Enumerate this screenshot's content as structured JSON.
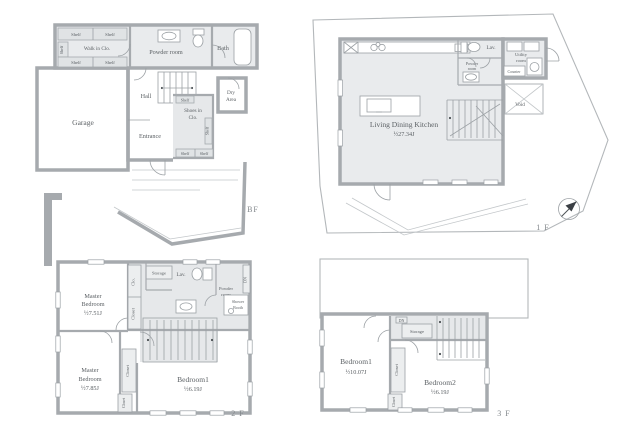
{
  "title": "Floor plans",
  "colors": {
    "wall": "#a6aaae",
    "room_fill": "#e9ebed",
    "line": "#b3b7ba",
    "text": "#5c6165"
  },
  "floors": {
    "bf": {
      "label": "BF",
      "shelf": "Shelf",
      "walk_in_closet": "Walk in Clo.",
      "powder_room": "Powder room",
      "bath": "Bath",
      "hall": "Hall",
      "shoes_closet_l1": "Shoes in",
      "shoes_closet_l2": "Clo.",
      "dry_area_l1": "Dry",
      "dry_area_l2": "Area",
      "entrance": "Entrance",
      "garage": "Garage"
    },
    "f1": {
      "label": "1 F",
      "ldk_name": "Living Dining Kitchen",
      "ldk_area": "½27.34J",
      "lav": "Lav.",
      "powder_l1": "Powder",
      "powder_l2": "room",
      "utility_l1": "Utility",
      "utility_l2": "room",
      "counter": "Counter",
      "void": "Void"
    },
    "f2": {
      "label": "2 F",
      "master_top_l1": "Master",
      "master_top_l2": "Bedroom",
      "master_top_area": "½7.51J",
      "master_bottom_l1": "Master",
      "master_bottom_l2": "Bedroom",
      "master_bottom_area": "½7.85J",
      "bedroom1": "Bedroom1",
      "bedroom1_area": "½6.19J",
      "clo": "Clo.",
      "closet": "Closet",
      "storage": "Storage",
      "lav": "Lav.",
      "powder_l1": "Powder",
      "powder_l2": "room",
      "shower_l1": "Shower",
      "shower_l2": "Booth",
      "dn": "DN"
    },
    "f3": {
      "label": "3 F",
      "bedroom1": "Bedroom1",
      "bedroom1_area": "½10.07J",
      "bedroom2": "Bedroom2",
      "bedroom2_area": "½6.19J",
      "storage": "Storage",
      "closet": "Closet",
      "dn": "DN"
    }
  }
}
